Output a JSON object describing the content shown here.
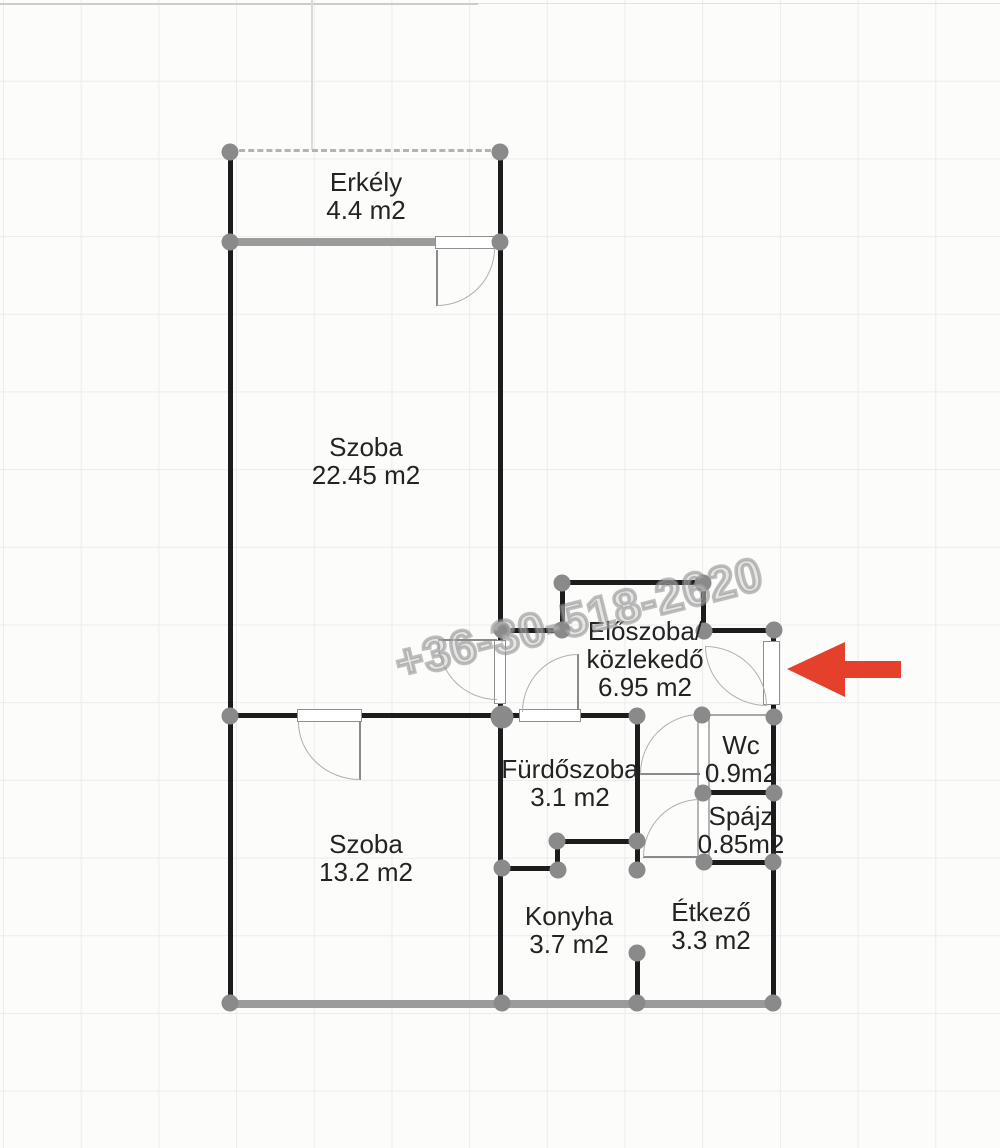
{
  "watermark": "+36-30-518-2620",
  "rooms": [
    {
      "id": "erkely",
      "name": "Erkély",
      "area": "4.4 m2"
    },
    {
      "id": "szoba-nagy",
      "name": "Szoba",
      "area": "22.45 m2"
    },
    {
      "id": "eloszoba",
      "name": "Előszoba/",
      "name2": "közlekedő",
      "area": "6.95 m2"
    },
    {
      "id": "furdoszoba",
      "name": "Fürdőszoba",
      "area": "3.1 m2"
    },
    {
      "id": "wc",
      "name": "Wc",
      "area": "0.9m2"
    },
    {
      "id": "spajz",
      "name": "Spájz",
      "area": "0.85m2"
    },
    {
      "id": "szoba-kis",
      "name": "Szoba",
      "area": "13.2 m2"
    },
    {
      "id": "konyha",
      "name": "Konyha",
      "area": "3.7 m2"
    },
    {
      "id": "etkezo",
      "name": "Étkező",
      "area": "3.3 m2"
    }
  ],
  "colors": {
    "wall": "#1c1c1c",
    "wall-light": "#9b9b9b",
    "node": "#8a8a8a",
    "label": "#232323",
    "arrow": "#e5402b"
  }
}
